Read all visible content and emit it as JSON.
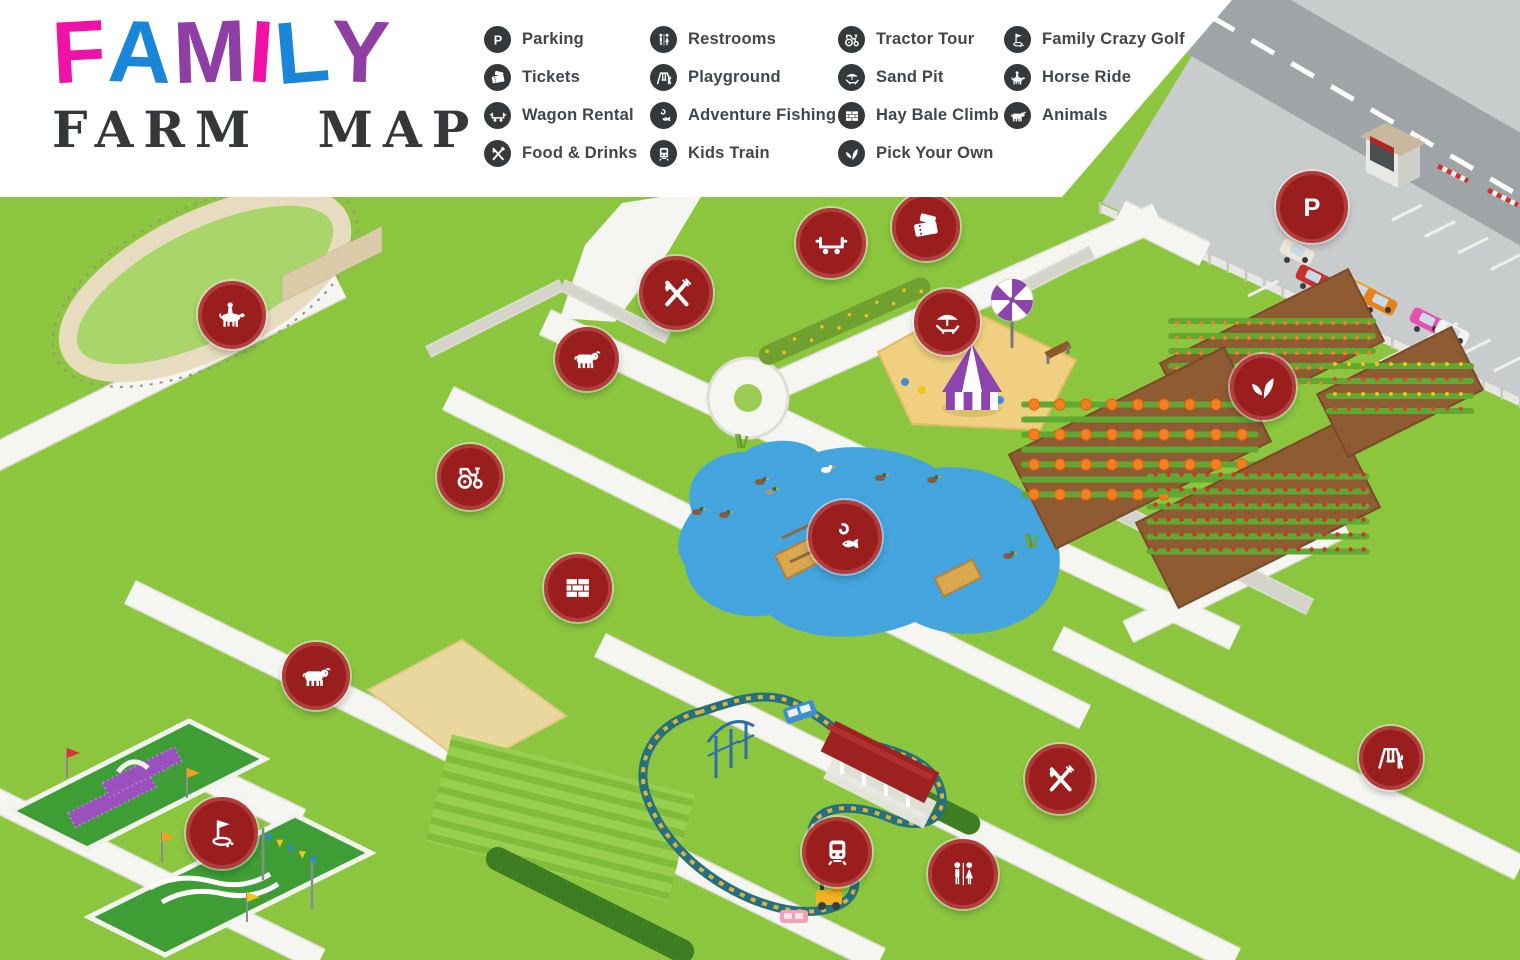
{
  "title": {
    "letters": [
      {
        "ch": "F",
        "color": "#F012A6"
      },
      {
        "ch": "A",
        "color": "#1B86D8"
      },
      {
        "ch": "M",
        "color": "#8F3FA4"
      },
      {
        "ch": "I",
        "color": "#F012A6"
      },
      {
        "ch": "L",
        "color": "#1B86D8"
      },
      {
        "ch": "Y",
        "color": "#8F3FA4"
      }
    ],
    "subtitle": "FARM MAP",
    "subtitle_color": "#35383A"
  },
  "legend": {
    "icon_bg": "#35393B",
    "text_color": "#41464A",
    "columns": [
      [
        {
          "icon": "parking",
          "label": "Parking"
        },
        {
          "icon": "tickets",
          "label": "Tickets"
        },
        {
          "icon": "wagon-rental",
          "label": "Wagon Rental"
        },
        {
          "icon": "food-drinks",
          "label": "Food & Drinks"
        }
      ],
      [
        {
          "icon": "restrooms",
          "label": "Restrooms"
        },
        {
          "icon": "playground",
          "label": "Playground"
        },
        {
          "icon": "adventure-fishing",
          "label": "Adventure Fishing"
        },
        {
          "icon": "kids-train",
          "label": "Kids Train"
        }
      ],
      [
        {
          "icon": "tractor-tour",
          "label": "Tractor Tour"
        },
        {
          "icon": "sand-pit",
          "label": "Sand Pit"
        },
        {
          "icon": "hay-bale-climb",
          "label": "Hay Bale Climb"
        },
        {
          "icon": "pick-your-own",
          "label": "Pick Your Own"
        }
      ],
      [
        {
          "icon": "family-crazy-golf",
          "label": "Family Crazy Golf"
        },
        {
          "icon": "horse-ride",
          "label": "Horse Ride"
        },
        {
          "icon": "animals",
          "label": "Animals"
        }
      ]
    ]
  },
  "markers": [
    {
      "id": "horse-ride",
      "icon": "horse-ride",
      "label": "Horse Ride",
      "x": 232,
      "y": 315,
      "size": 60
    },
    {
      "id": "food-drinks-barn",
      "icon": "food-drinks",
      "label": "Food & Drinks",
      "x": 676,
      "y": 293,
      "size": 66
    },
    {
      "id": "wagon-rental",
      "icon": "wagon-rental",
      "label": "Wagon Rental",
      "x": 831,
      "y": 243,
      "size": 62
    },
    {
      "id": "tickets",
      "icon": "tickets",
      "label": "Tickets",
      "x": 926,
      "y": 227,
      "size": 60
    },
    {
      "id": "sand-pit",
      "icon": "sand-pit",
      "label": "Sand Pit",
      "x": 947,
      "y": 322,
      "size": 58
    },
    {
      "id": "parking",
      "icon": "parking",
      "label": "Parking",
      "x": 1312,
      "y": 207,
      "size": 64
    },
    {
      "id": "pick-your-own",
      "icon": "pick-your-own",
      "label": "Pick Your Own",
      "x": 1263,
      "y": 387,
      "size": 58
    },
    {
      "id": "animals-barn",
      "icon": "animals",
      "label": "Animals",
      "x": 587,
      "y": 359,
      "size": 56
    },
    {
      "id": "tractor-tour",
      "icon": "tractor-tour",
      "label": "Tractor Tour",
      "x": 470,
      "y": 477,
      "size": 58
    },
    {
      "id": "hay-bale-climb",
      "icon": "hay-bale-climb",
      "label": "Hay Bale Climb",
      "x": 578,
      "y": 588,
      "size": 60
    },
    {
      "id": "adventure-fishing",
      "icon": "adventure-fishing",
      "label": "Adventure Fishing",
      "x": 845,
      "y": 537,
      "size": 66
    },
    {
      "id": "animals-farmyard",
      "icon": "animals",
      "label": "Animals",
      "x": 316,
      "y": 676,
      "size": 60
    },
    {
      "id": "family-crazy-golf",
      "icon": "family-crazy-golf",
      "label": "Family Crazy Golf",
      "x": 222,
      "y": 833,
      "size": 64
    },
    {
      "id": "kids-train",
      "icon": "kids-train",
      "label": "Kids Train",
      "x": 837,
      "y": 852,
      "size": 62
    },
    {
      "id": "restrooms",
      "icon": "restrooms",
      "label": "Restrooms",
      "x": 963,
      "y": 874,
      "size": 62
    },
    {
      "id": "food-drinks-stalls",
      "icon": "food-drinks",
      "label": "Food & Drinks",
      "x": 1060,
      "y": 779,
      "size": 62
    },
    {
      "id": "playground",
      "icon": "playground",
      "label": "Playground",
      "x": 1391,
      "y": 758,
      "size": 56
    }
  ],
  "colors": {
    "grass": "#8CC63F",
    "path": "#F5F5F1",
    "path_edge": "#DEDED6",
    "road": "#9FA4A7",
    "parking_lot": "#C9CCCD",
    "pond": "#43A4DE",
    "sand": "#F0D080",
    "marker_bg": "#9B1E1E",
    "marker_ring": "#B23C3C",
    "barn_roof": "#8E1B1B",
    "barn_wall": "#E2DBC9",
    "header_bg": "#FFFFFF"
  }
}
